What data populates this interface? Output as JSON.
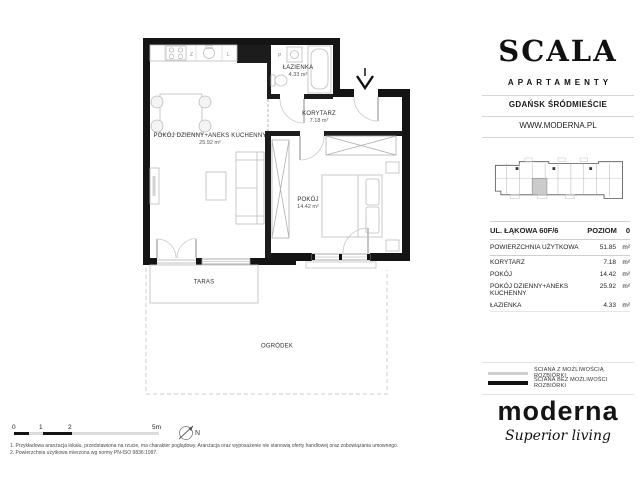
{
  "branding": {
    "logo_title": "SCALA",
    "logo_subtitle": "APARTAMENTY",
    "location": "GDAŃSK ŚRÓDMIEŚCIE",
    "website": "WWW.MODERNA.PL",
    "developer_name": "moderna",
    "developer_tagline": "Superior living"
  },
  "unit": {
    "address": "UL. ŁĄKOWA 60F/6",
    "level_label": "POZIOM",
    "level_value": "0",
    "total_label": "POWIERZCHNIA UŻYTKOWA",
    "total_value": "51.85",
    "unit_symbol": "m²",
    "rooms": [
      {
        "name": "KORYTARZ",
        "area": "7.18"
      },
      {
        "name": "POKÓJ",
        "area": "14.42"
      },
      {
        "name": "POKÓJ DZIENNY+ANEKS KUCHENNY",
        "area": "25.92"
      },
      {
        "name": "ŁAZIENKA",
        "area": "4.33"
      }
    ]
  },
  "legend": {
    "items": [
      {
        "label": "ŚCIANA Z MOŻLIWOŚCIĄ ROZBIÓRKI",
        "style": "light"
      },
      {
        "label": "ŚCIANA BEZ MOŻLIWOŚCI ROZBIÓRKI",
        "style": "dark"
      }
    ]
  },
  "plan": {
    "living": {
      "name": "POKÓJ DZIENNY+ANEKS KUCHENNY",
      "area": "25.92 m²"
    },
    "bathroom": {
      "name": "ŁAZIENKA",
      "area": "4.33 m²"
    },
    "corridor": {
      "name": "KORYTARZ",
      "area": "7.18 m²"
    },
    "bedroom": {
      "name": "POKÓJ",
      "area": "14.42 m²"
    },
    "terrace": "TARAS",
    "garden": "OGRÓDEK",
    "kitchen_marks": {
      "z": "Z",
      "l": "L",
      "p": "P"
    }
  },
  "scalebar": {
    "t0": "0",
    "t1": "1",
    "t2": "2",
    "t5": "5m",
    "north": "N"
  },
  "footnotes": {
    "line1": "1. Przykładowa aranżacja lokalu, przedstawiona na rzucie, ma charakter poglądowy. Aranżacja oraz wyposażenie nie stanowią oferty handlowej oraz zobowiązania umownego.",
    "line2": "2. Powierzchnia użytkowa mierzona wg normy PN-ISO 9836:1997."
  },
  "colors": {
    "wall": "#141414",
    "highlight_unit": "#cbcbcb"
  }
}
